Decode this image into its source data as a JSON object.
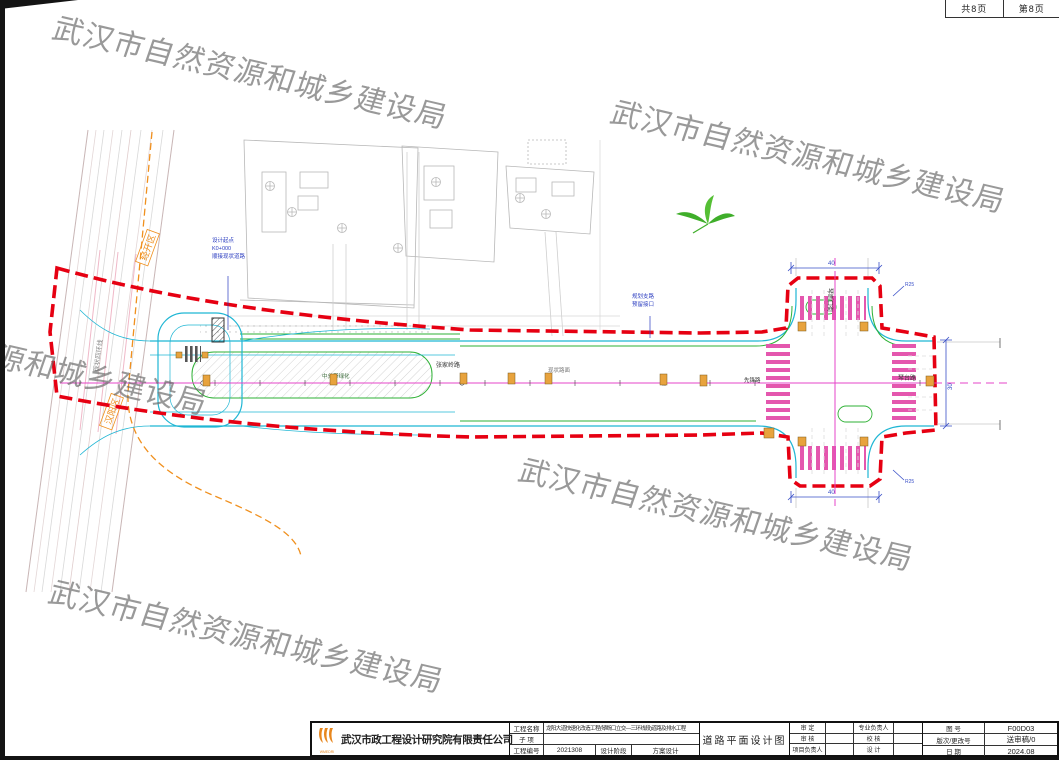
{
  "page": {
    "watermark_text": "武汉市自然资源和城乡建设局",
    "pages_total_label": "共8页",
    "page_number_label": "第8页"
  },
  "drawing": {
    "district_labels": {
      "jingkai": "经开区",
      "hanyang": "汉阳区"
    },
    "corridor_label": "现状四环线",
    "road_labels": {
      "center_road": "张家岭路",
      "west_road": "先锋路",
      "east_road": "琴台路",
      "north_road": "琴断口街",
      "island": "中分带绿化",
      "pavement": "现状路面"
    },
    "notes": {
      "start_note": [
        "设计起点",
        "K0+000",
        "顺接现状道路"
      ],
      "mid_note": [
        "规划支路",
        "预留接口"
      ]
    },
    "dims": {
      "north": "40",
      "south": "40",
      "east": "30",
      "radius": "R25"
    }
  },
  "titleblock": {
    "company": "武汉市政工程设计研究院有限责任公司",
    "logo_text": "WMEDRI",
    "project_name_label": "工程名称",
    "project_name": "龙阳大道快速化改造工程(琴断口立交—三环线段)道路及排水工程",
    "subitem_label": "子  项",
    "subitem": "",
    "project_no_label": "工程编号",
    "project_no": "2021308",
    "stage_label": "设计阶段",
    "stage": "方案设计",
    "drawing_title": "道路平面设计图",
    "approve_label": "审  定",
    "review_label": "审  核",
    "pm_label": "项目负责人",
    "discipline_lead_label": "专业负责人",
    "check_label": "校  核",
    "design_label": "设  计",
    "fig_no_label": "图  号",
    "fig_no": "F00D03",
    "rev_label": "版次/更改号",
    "rev": "送审稿/0",
    "date_label": "日  期",
    "date": "2024.08"
  }
}
